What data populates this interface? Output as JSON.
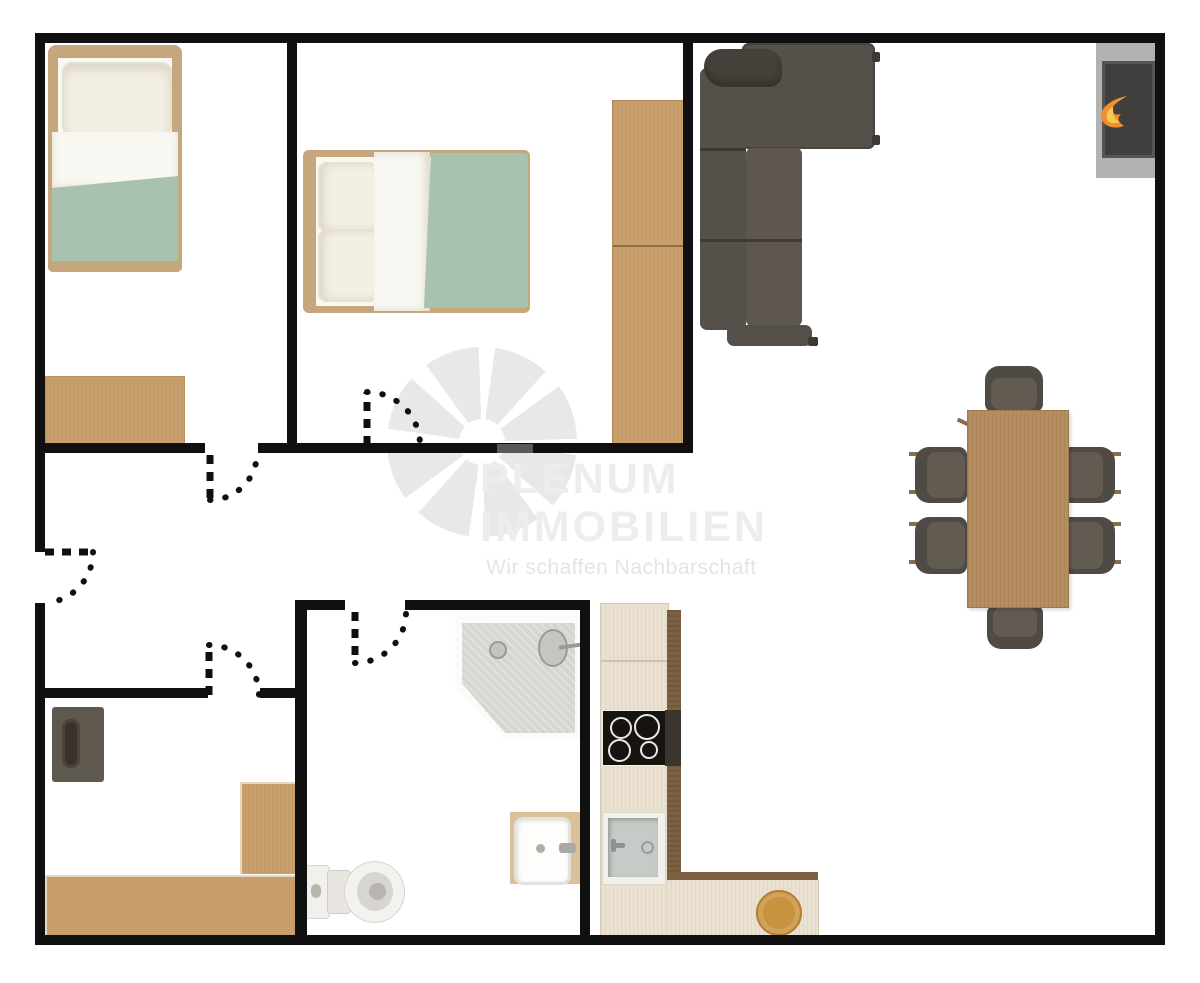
{
  "watermark": {
    "brand_line1": "PLENUM",
    "brand_line2": "IMMOBILIEN",
    "tagline": "Wir schaffen Nachbarschaft"
  },
  "colors": {
    "wall": "#101010",
    "door_gray": "#58585a",
    "wood": "#c9a06d",
    "wood_dark": "#7e6042",
    "table_wood": "#b58e5f",
    "kitchen_base": "#eae1d0",
    "cooktop": "#17130f",
    "cooktop_side": "#3a332e",
    "steel": "#c7cbc7",
    "sofa": "#55504a",
    "sofa_seat": "#5d5750",
    "chair": "#4f4a43",
    "chair_seat": "#615b52",
    "green": "#a9c2b0",
    "bedding_white": "#faf8f3",
    "pillow": "#f3efe4",
    "fire_frame": "#b3b2b1",
    "fire_inner": "#403f3d",
    "flame": "#ef8f2e",
    "flame_core": "#f8c653",
    "board": "#c8923e",
    "appliance": "#5f584f",
    "appliance_slot": "#39332b",
    "shower_tray": "#d6d5d1",
    "bath_sink_base": "#dcc09a",
    "watermark_text": "#eeedec",
    "watermark_tagline": "#e7e3e2",
    "watermark_logo": "#e9e8e7"
  }
}
